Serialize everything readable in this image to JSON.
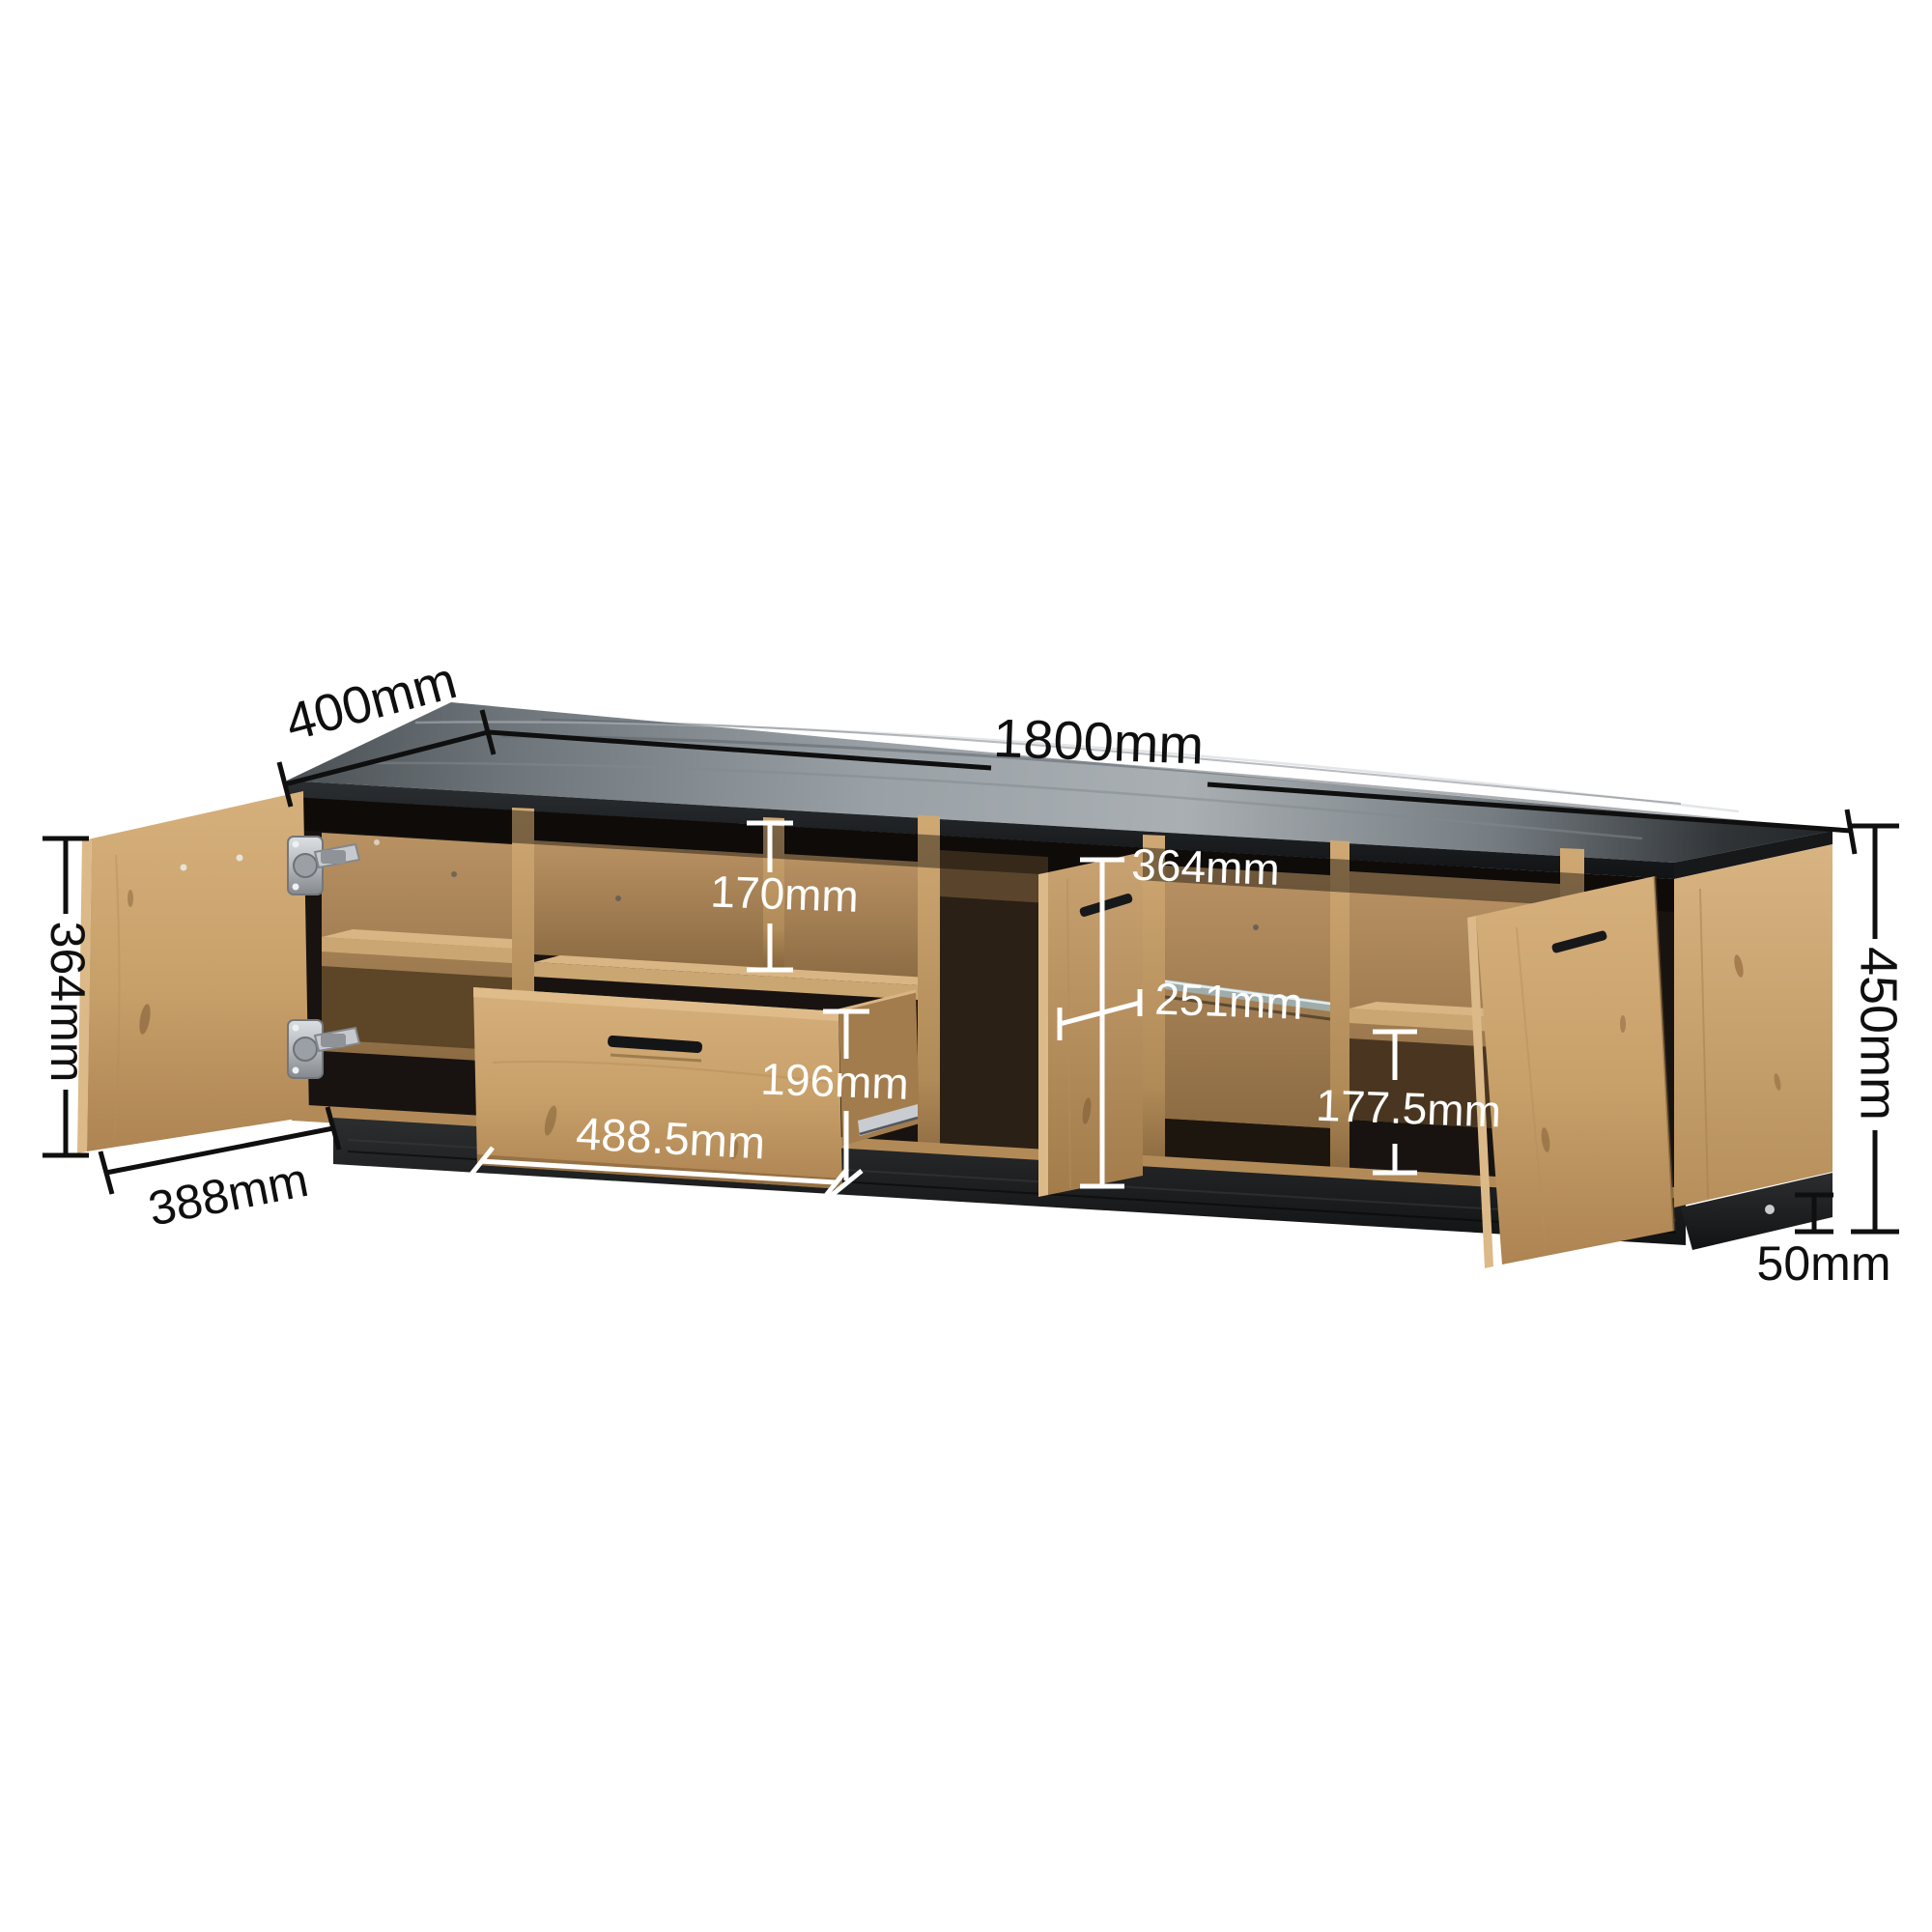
{
  "title": "TV stand dimension diagram",
  "unit": "mm",
  "dimensions": {
    "top_depth": "400mm",
    "top_width": "1800mm",
    "left_door_height": "364mm",
    "left_door_width": "388mm",
    "open_compartment_height": "170mm",
    "drawer_front_height": "196mm",
    "drawer_front_width": "488.5mm",
    "middle_door_height": "364mm",
    "middle_door_width": "251mm",
    "right_compartment_height": "177.5mm",
    "overall_height": "450mm",
    "base_height": "50mm"
  },
  "annotation_colors": {
    "outer_labels": "#0f0f0f",
    "inner_labels": "#ffffff"
  },
  "material_colors": {
    "oak": "#c79f69",
    "oak_light_edge": "#dcb988",
    "oak_interior": "#a98a60",
    "top_panel_gray": "#9aa1a6",
    "black_trim": "#17181a",
    "hinge_silver": "#c0c3c7",
    "glass_shelf": "#9fb4ba"
  }
}
